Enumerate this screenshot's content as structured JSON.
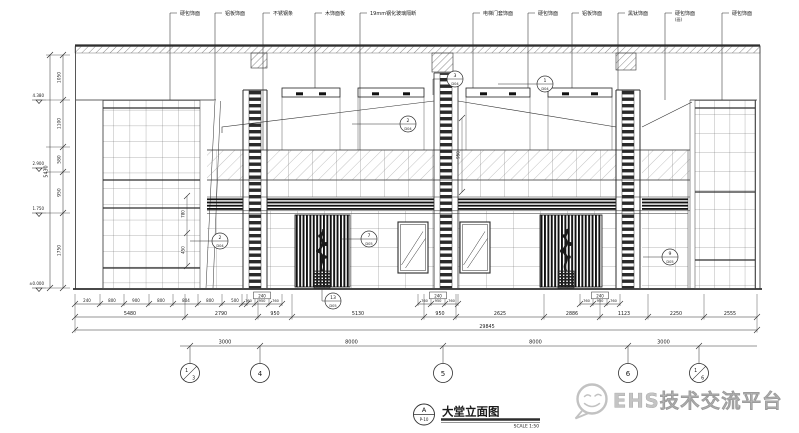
{
  "drawing": {
    "title": "大堂立面图",
    "scale_note": "SCALE 1:50",
    "tag_top": "A",
    "tag_bottom": "P-10",
    "watermark": "EHS技术交流平台"
  },
  "callouts": [
    {
      "label": "硬包饰面"
    },
    {
      "label": "铝板饰面"
    },
    {
      "label": "不锈钢条"
    },
    {
      "label": "木饰面板"
    },
    {
      "label": "19mm钢化玻璃隔断"
    },
    {
      "label": "电梯门套饰面"
    },
    {
      "label": "硬包饰面"
    },
    {
      "label": "铝板饰面"
    },
    {
      "label": "黑钛饰面"
    },
    {
      "label": "硬包饰面",
      "sub": "(画)"
    },
    {
      "label": "硬包饰面"
    }
  ],
  "levels": [
    "4.380",
    "2.900",
    "1.750",
    "±0.000"
  ],
  "left_dims": {
    "overall": "5430",
    "segments": [
      "1050",
      "1100",
      "580",
      "950",
      "1750"
    ]
  },
  "inner_dims": {
    "v1a": "780",
    "v1b": "450",
    "v2": "950"
  },
  "detail_tags": [
    {
      "top": "1",
      "bottom": "D04"
    },
    {
      "top": "2",
      "bottom": "D04"
    },
    {
      "top": "7",
      "bottom": "D05"
    },
    {
      "top": "13",
      "bottom": "D05"
    },
    {
      "top": "2",
      "bottom": "D04"
    },
    {
      "top": "9",
      "bottom": "D05"
    },
    {
      "top": "3",
      "bottom": "D04"
    }
  ],
  "cluster_dims": {
    "box": "240",
    "left": "760",
    "mid": "950",
    "right": "760"
  },
  "bottom_dims": {
    "rowA": [
      "240",
      "800",
      "900",
      "800",
      "804",
      "800",
      "500"
    ],
    "rowB": [
      "5480",
      "2790",
      "950",
      "5130",
      "950",
      "2625",
      "2886",
      "1123",
      "2250",
      "2555"
    ],
    "overall": "29845"
  },
  "axis": {
    "dims": [
      "3000",
      "8000",
      "8000",
      "3000"
    ],
    "bubbles": [
      {
        "a": "1",
        "b": "3"
      },
      {
        "label": "4"
      },
      {
        "label": "5"
      },
      {
        "label": "6"
      },
      {
        "a": "1",
        "b": "6"
      }
    ]
  }
}
